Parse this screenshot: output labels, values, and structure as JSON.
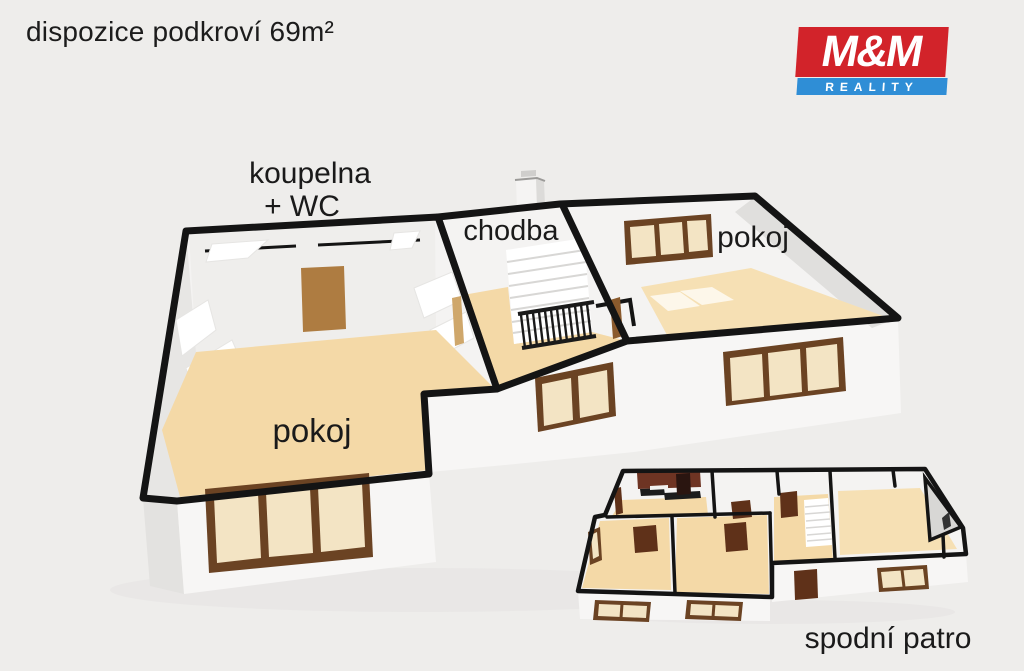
{
  "page": {
    "title": "dispozice podkroví 69m²",
    "background": "#eeedeb"
  },
  "logo": {
    "line1": "M&M",
    "line2": "REALITY",
    "red": "#d2232a",
    "blue": "#2f8ed6"
  },
  "plans": {
    "upper": {
      "labels": {
        "bathroom_line1": "koupelna",
        "bathroom_line2": "+ WC",
        "hallway": "chodba",
        "room_right": "pokoj",
        "room_left": "pokoj"
      }
    },
    "lower": {
      "label": "spodní patro"
    }
  },
  "colors": {
    "wall": "#f7f6f5",
    "wall_shade": "#e3e2e0",
    "outline": "#141414",
    "floor": "#f4d9a7",
    "floor_light": "#f6e0b4",
    "window_pane": "#f3e4c4",
    "frame_brown": "#6b4323",
    "door_brown": "#ae7c41",
    "kitchen_brown": "#6e3423"
  }
}
